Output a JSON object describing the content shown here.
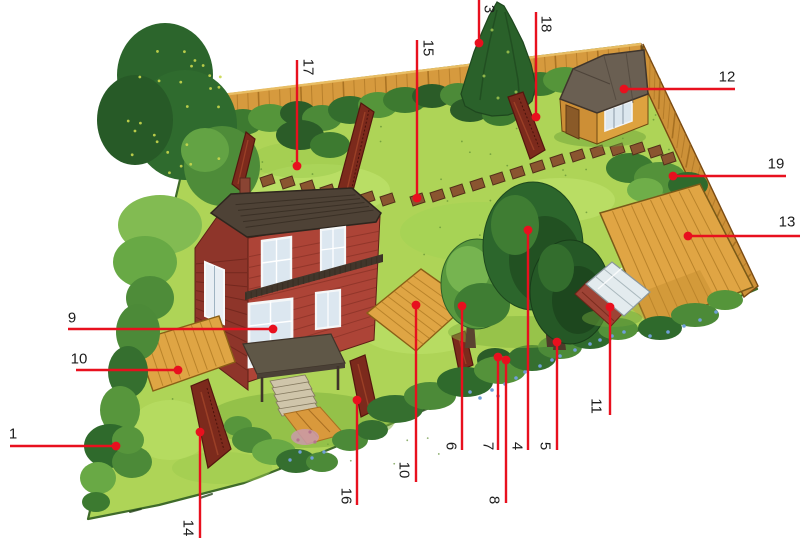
{
  "figure": {
    "kind": "garden-plan-illustration",
    "description": "Bird's-eye watercolor illustration of a natural garden plot with red numbered callout lines",
    "callout_color": "#e8101e",
    "number_color": "#1c1c1c"
  },
  "callouts": [
    {
      "label": "1",
      "rot": false,
      "num": [
        13,
        434
      ],
      "line": [
        [
          10,
          446
        ],
        [
          116,
          446
        ]
      ],
      "dot": [
        116,
        446
      ]
    },
    {
      "label": "3",
      "rot": true,
      "num": [
        489,
        9
      ],
      "line": [
        [
          479,
          0
        ],
        [
          479,
          43
        ]
      ],
      "dot": [
        479,
        43
      ]
    },
    {
      "label": "4",
      "rot": true,
      "num": [
        517,
        446
      ],
      "line": [
        [
          528,
          230
        ],
        [
          528,
          450
        ]
      ],
      "dot": [
        528,
        230
      ]
    },
    {
      "label": "5",
      "rot": true,
      "num": [
        545,
        446
      ],
      "line": [
        [
          557,
          342
        ],
        [
          557,
          450
        ]
      ],
      "dot": [
        557,
        342
      ]
    },
    {
      "label": "6",
      "rot": true,
      "num": [
        451,
        446
      ],
      "line": [
        [
          462,
          306
        ],
        [
          462,
          450
        ]
      ],
      "dot": [
        462,
        306
      ]
    },
    {
      "label": "7",
      "rot": true,
      "num": [
        488,
        446
      ],
      "line": [
        [
          498,
          357
        ],
        [
          498,
          450
        ]
      ],
      "dot": [
        498,
        357
      ]
    },
    {
      "label": "8",
      "rot": true,
      "num": [
        494,
        500
      ],
      "line": [
        [
          506,
          360
        ],
        [
          506,
          503
        ]
      ],
      "dot": [
        506,
        360
      ]
    },
    {
      "label": "9",
      "rot": false,
      "num": [
        72,
        318
      ],
      "line": [
        [
          68,
          329
        ],
        [
          273,
          329
        ]
      ],
      "dot": [
        273,
        329
      ]
    },
    {
      "label": "10",
      "rot": false,
      "num": [
        79,
        359
      ],
      "line": [
        [
          76,
          370
        ],
        [
          178,
          370
        ]
      ],
      "dot": [
        178,
        370
      ]
    },
    {
      "label": "10",
      "rot": true,
      "num": [
        404,
        470
      ],
      "line": [
        [
          416,
          305
        ],
        [
          416,
          482
        ]
      ],
      "dot": [
        416,
        305
      ]
    },
    {
      "label": "11",
      "rot": true,
      "num": [
        596,
        406
      ],
      "line": [
        [
          610,
          307
        ],
        [
          610,
          415
        ]
      ],
      "dot": [
        610,
        307
      ]
    },
    {
      "label": "12",
      "rot": false,
      "num": [
        727,
        77
      ],
      "line": [
        [
          624,
          89
        ],
        [
          735,
          89
        ]
      ],
      "dot": [
        624,
        89
      ]
    },
    {
      "label": "13",
      "rot": false,
      "num": [
        787,
        222
      ],
      "line": [
        [
          688,
          236
        ],
        [
          800,
          236
        ]
      ],
      "dot": [
        688,
        236
      ]
    },
    {
      "label": "14",
      "rot": true,
      "num": [
        188,
        528
      ],
      "line": [
        [
          200,
          432
        ],
        [
          200,
          538
        ]
      ],
      "dot": [
        200,
        432
      ]
    },
    {
      "label": "15",
      "rot": true,
      "num": [
        428,
        48
      ],
      "line": [
        [
          417,
          40
        ],
        [
          417,
          198
        ]
      ],
      "dot": [
        417,
        198
      ]
    },
    {
      "label": "16",
      "rot": true,
      "num": [
        346,
        496
      ],
      "line": [
        [
          357,
          400
        ],
        [
          357,
          505
        ]
      ],
      "dot": [
        357,
        400
      ]
    },
    {
      "label": "17",
      "rot": true,
      "num": [
        308,
        67
      ],
      "line": [
        [
          297,
          60
        ],
        [
          297,
          166
        ]
      ],
      "dot": [
        297,
        166
      ]
    },
    {
      "label": "18",
      "rot": true,
      "num": [
        546,
        24
      ],
      "line": [
        [
          536,
          12
        ],
        [
          536,
          117
        ]
      ],
      "dot": [
        536,
        117
      ]
    },
    {
      "label": "19",
      "rot": false,
      "num": [
        776,
        164
      ],
      "line": [
        [
          673,
          176
        ],
        [
          786,
          176
        ]
      ],
      "dot": [
        673,
        176
      ]
    }
  ]
}
